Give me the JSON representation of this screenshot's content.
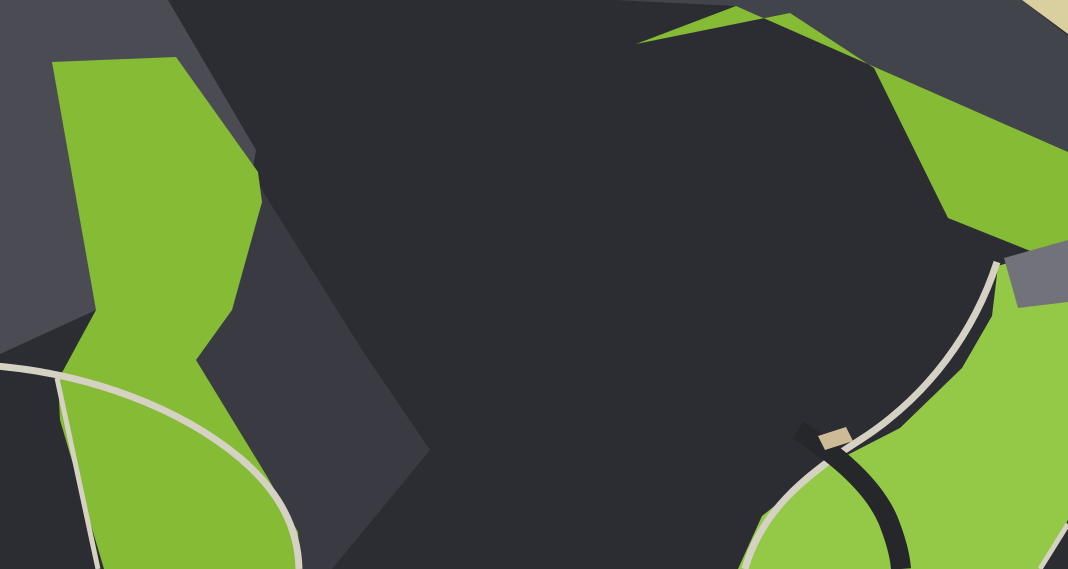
{
  "meta": {
    "title": "Aerial 3D architectural rendering of a two-level parking structure with full rooftop parking deck, ground-level parking bays, access roads with painted arrows, lawns, trees and a stair tower",
    "width": 1068,
    "height": 569
  },
  "palette": {
    "base": "#2c2d32",
    "lotLane": "#3a3b42",
    "tlRoad": "#4b4c53",
    "trRoad": "#42444b",
    "deck": "#7e786e",
    "deckLight": "#867f74",
    "grass": "#85bb35",
    "grassLight": "#94c847",
    "grassDark": "#6da32b",
    "curb": "#d5d1c3",
    "walk": "#aaa79e",
    "grayPath": "#72737a",
    "tanCorner": "#d9cf9f",
    "bldg": "#f3e6b1",
    "bldgSide": "#e6d493",
    "bldgSlot": "#6f6b5d",
    "ramp": "#eedfa0",
    "rampWall": "#dfcc82",
    "white": "#f3f3ef",
    "whiteShade": "#d9d9d4",
    "louver": "#a49f94",
    "louverLine": "#6e695f",
    "colFront": "#ecebe7",
    "colSide": "#c6c5c0",
    "fence": "#232327",
    "steps": "#303034",
    "stepsBand": "#45454b",
    "stairSide": "#c9c6b9",
    "mark": "#f2f1ec",
    "treeDark": "#4e8335",
    "tree": "#69a23f",
    "treeLight": "#82b94e",
    "rock": "#cdbb97",
    "rockEdge": "#b1a07e",
    "bench": "#e2dfd3",
    "glass": "#7c8ca2",
    "glassDark": "#55647a",
    "marker": "#ef9433",
    "post": "#2c3240"
  },
  "car_colors": {
    "silver": {
      "b": "#d5d7dc",
      "h": "#edeff2",
      "s": "#b6b9c0"
    },
    "white": {
      "b": "#e9eaed",
      "h": "#f9fafb",
      "s": "#cfd2d6"
    },
    "gray": {
      "b": "#9b9ea4",
      "h": "#b8bbc0",
      "s": "#83868c"
    },
    "dark": {
      "b": "#44474d",
      "h": "#5d6168",
      "s": "#303338"
    }
  },
  "roof_colors": {
    "tan": "#d7c18d",
    "silver": "#cdd0d5",
    "white": "#e3e5e8",
    "dark": "#52565c"
  },
  "ground": {
    "lot_lane": [
      [
        96,
        310
      ],
      [
        252,
        174
      ],
      [
        362,
        350
      ],
      [
        430,
        450
      ],
      [
        332,
        569
      ],
      [
        300,
        569
      ],
      [
        268,
        478
      ],
      [
        196,
        360
      ]
    ],
    "tl_road": [
      [
        0,
        0
      ],
      [
        168,
        0
      ],
      [
        256,
        150
      ],
      [
        252,
        174
      ],
      [
        96,
        310
      ],
      [
        0,
        354
      ]
    ],
    "tr_road": [
      [
        616,
        0
      ],
      [
        1022,
        0
      ],
      [
        1068,
        36
      ],
      [
        1068,
        152
      ],
      [
        736,
        6
      ]
    ],
    "tr_corner": [
      [
        1022,
        0
      ],
      [
        1068,
        0
      ],
      [
        1068,
        34
      ]
    ],
    "grass_left": [
      [
        52,
        62
      ],
      [
        176,
        57
      ],
      [
        258,
        172
      ],
      [
        262,
        202
      ],
      [
        232,
        310
      ],
      [
        196,
        360
      ],
      [
        268,
        478
      ],
      [
        298,
        532
      ],
      [
        300,
        569
      ],
      [
        104,
        569
      ],
      [
        60,
        420
      ],
      [
        58,
        380
      ],
      [
        96,
        310
      ]
    ],
    "grass_tr": [
      [
        636,
        44
      ],
      [
        736,
        6
      ],
      [
        1068,
        152
      ],
      [
        1068,
        266
      ],
      [
        948,
        218
      ],
      [
        874,
        68
      ],
      [
        790,
        13
      ]
    ],
    "grass_br": [
      [
        998,
        266
      ],
      [
        1068,
        244
      ],
      [
        1068,
        520
      ],
      [
        1040,
        569
      ],
      [
        738,
        569
      ],
      [
        762,
        516
      ],
      [
        822,
        468
      ],
      [
        900,
        428
      ],
      [
        962,
        368
      ],
      [
        992,
        316
      ]
    ],
    "gray_path": [
      [
        1004,
        258
      ],
      [
        1068,
        240
      ],
      [
        1068,
        302
      ],
      [
        1018,
        308
      ]
    ],
    "curb_bl": "M -4,366 C 90,374 180,408 240,458 C 280,492 298,528 299,569",
    "curb_left": "M 57,378 L 98,569",
    "curb_br": "M 997,262 C 975,330 930,395 860,440 C 800,478 760,515 745,569",
    "curb_corner": "M 1040,569 L 1068,524",
    "br_path": "M 798,430 C 845,460 875,490 888,520 C 896,540 900,555 901,569",
    "stone_wall": [
      [
        818,
        436
      ],
      [
        846,
        427
      ],
      [
        853,
        441
      ],
      [
        825,
        450
      ]
    ]
  },
  "building": {
    "body": [
      [
        168,
        0
      ],
      [
        622,
        0
      ],
      [
        622,
        55
      ],
      [
        256,
        150
      ]
    ],
    "left_face": [
      [
        168,
        0
      ],
      [
        200,
        0
      ],
      [
        268,
        140
      ],
      [
        256,
        150
      ]
    ],
    "slot": [
      [
        543,
        0
      ],
      [
        560,
        0
      ],
      [
        560,
        46
      ],
      [
        543,
        52
      ]
    ],
    "seams": [
      [
        350,
        0,
        385,
        92
      ],
      [
        480,
        0,
        505,
        82
      ]
    ],
    "shadow": [
      [
        172,
        112
      ],
      [
        618,
        57
      ],
      [
        628,
        72
      ],
      [
        258,
        182
      ],
      [
        182,
        130
      ]
    ],
    "walkway": [
      254,
      170,
      610,
      74
    ],
    "fence": [
      [
        174,
        110
      ],
      [
        618,
        56
      ]
    ],
    "ramps": [
      {
        "x": 316,
        "y": 102,
        "rot": 250,
        "sc": 0.8
      },
      {
        "x": 450,
        "y": 82,
        "rot": 250,
        "sc": 1.0
      },
      {
        "x": 575,
        "y": 52,
        "rot": 250,
        "sc": 1.0
      }
    ]
  },
  "deck": {
    "surface": [
      [
        218,
        196
      ],
      [
        612,
        60
      ],
      [
        790,
        12
      ],
      [
        875,
        70
      ],
      [
        948,
        216
      ],
      [
        362,
        348
      ]
    ],
    "sun_patch": [
      [
        612,
        60
      ],
      [
        790,
        12
      ],
      [
        875,
        70
      ],
      [
        948,
        216
      ],
      [
        760,
        150
      ]
    ],
    "fence_edge": [
      [
        790,
        12
      ],
      [
        872,
        66
      ],
      [
        948,
        216
      ]
    ],
    "slope_fences": [
      [
        [
          628,
          58
        ],
        [
          736,
          8
        ]
      ],
      [
        [
          736,
          8
        ],
        [
          1068,
          148
        ]
      ]
    ],
    "aisle_dashes": [
      [
        402,
        150,
        470,
        257
      ],
      [
        586,
        96,
        668,
        225
      ],
      [
        742,
        52,
        822,
        178
      ]
    ],
    "fascia_se": [
      [
        948,
        216
      ],
      [
        362,
        348
      ],
      [
        362,
        361
      ],
      [
        948,
        229
      ]
    ],
    "fascia_w": [
      [
        362,
        348
      ],
      [
        218,
        196
      ],
      [
        218,
        209
      ],
      [
        362,
        361
      ]
    ],
    "louver_se": [
      [
        948,
        229
      ],
      [
        362,
        361
      ],
      [
        362,
        386
      ],
      [
        948,
        254
      ]
    ],
    "louver_w": [
      [
        362,
        361
      ],
      [
        218,
        209
      ],
      [
        218,
        239
      ],
      [
        362,
        391
      ]
    ],
    "louver_lines_se": [
      [
        944,
        237,
        366,
        369
      ],
      [
        944,
        244,
        366,
        376
      ],
      [
        944,
        250,
        366,
        382
      ]
    ],
    "louver_lines_w": [
      [
        358,
        368,
        222,
        216
      ],
      [
        358,
        376,
        222,
        224
      ],
      [
        358,
        384,
        222,
        232
      ]
    ],
    "under_shadow": [
      [
        362,
        361
      ],
      [
        948,
        229
      ],
      [
        966,
        300
      ],
      [
        430,
        452
      ]
    ],
    "columns_se": [
      [
        895,
        266,
        84
      ],
      [
        800,
        287,
        74
      ],
      [
        706,
        309,
        64
      ],
      [
        612,
        330,
        54
      ],
      [
        518,
        351,
        46
      ],
      [
        424,
        372,
        40
      ]
    ],
    "columns_w": [
      [
        252,
        275,
        32
      ],
      [
        300,
        326,
        36
      ],
      [
        344,
        372,
        40
      ],
      [
        360,
        389,
        42
      ]
    ]
  },
  "tower": {
    "roof": [
      [
        912,
        92
      ],
      [
        1000,
        86
      ],
      [
        1009,
        114
      ],
      [
        920,
        121
      ]
    ],
    "skylight": [
      [
        938,
        99
      ],
      [
        985,
        95
      ],
      [
        992,
        110
      ],
      [
        945,
        114
      ]
    ],
    "front": [
      [
        920,
        121
      ],
      [
        1009,
        114
      ],
      [
        1009,
        275
      ],
      [
        928,
        264
      ]
    ],
    "side": [
      [
        906,
        129
      ],
      [
        920,
        121
      ],
      [
        928,
        264
      ],
      [
        911,
        252
      ]
    ],
    "window": [
      [
        950,
        184
      ],
      [
        983,
        180
      ],
      [
        985,
        226
      ],
      [
        952,
        230
      ]
    ]
  },
  "rows": [
    {
      "name": "deck-row-a",
      "start": [
        306,
        168
      ],
      "step": [
        14,
        22
      ],
      "count": 8,
      "rot": 237,
      "len": 54,
      "wid": 28,
      "tick": 24,
      "posts": true,
      "roofs": [
        "tan",
        "silver",
        "tan",
        "silver",
        "tan",
        "tan",
        "silver",
        "tan"
      ],
      "bodies": [
        "silver",
        "white",
        "silver",
        "silver",
        "white",
        "silver",
        "silver",
        "white"
      ]
    },
    {
      "name": "deck-row-b1",
      "start": [
        440,
        124
      ],
      "step": [
        15,
        22.5
      ],
      "count": 7,
      "rot": 237,
      "len": 54,
      "wid": 28,
      "tick": 24,
      "posts": true,
      "roofs": [
        "silver",
        "tan",
        "tan",
        "silver",
        "tan",
        "silver",
        "tan"
      ],
      "bodies": [
        "white",
        "silver",
        "silver",
        "white",
        "silver",
        "silver",
        "silver"
      ]
    },
    {
      "name": "deck-row-b2",
      "start": [
        484,
        110
      ],
      "step": [
        15,
        22.5
      ],
      "count": 7,
      "rot": 237,
      "len": 54,
      "wid": 28,
      "tick": 24,
      "posts": true,
      "roofs": [
        "tan",
        "silver",
        "tan",
        "tan",
        "silver",
        "tan",
        "silver"
      ],
      "bodies": [
        "silver",
        "silver",
        "white",
        "silver",
        "silver",
        "white",
        "silver"
      ]
    },
    {
      "name": "deck-row-c1",
      "start": [
        610,
        44
      ],
      "step": [
        15,
        22.5
      ],
      "count": 9,
      "rot": 237,
      "len": 54,
      "wid": 28,
      "tick": 24,
      "posts": true,
      "roofs": [
        "silver",
        "tan",
        "silver",
        "tan",
        "tan",
        "silver",
        "tan",
        "silver",
        "tan"
      ],
      "bodies": [
        "silver",
        "white",
        "silver",
        "silver",
        "white",
        "silver",
        "silver",
        "silver",
        "white"
      ]
    },
    {
      "name": "deck-row-c2",
      "start": [
        654,
        30
      ],
      "step": [
        15,
        22.5
      ],
      "count": 9,
      "rot": 237,
      "len": 54,
      "wid": 28,
      "tick": 24,
      "posts": true,
      "roofs": [
        "tan",
        "tan",
        "silver",
        "tan",
        "silver",
        "tan",
        "silver",
        "tan",
        "silver"
      ],
      "bodies": [
        "white",
        "silver",
        "silver",
        "white",
        "silver",
        "silver",
        "white",
        "silver",
        "silver"
      ]
    },
    {
      "name": "deck-row-d1",
      "start": [
        780,
        30
      ],
      "step": [
        15,
        22.5
      ],
      "count": 8,
      "rot": 237,
      "len": 54,
      "wid": 28,
      "tick": 24,
      "posts": true,
      "roofs": [
        "silver",
        "tan",
        "tan",
        "silver",
        "tan",
        "silver",
        "tan",
        "tan"
      ],
      "bodies": [
        "silver",
        "white",
        "silver",
        "silver",
        "silver",
        "white",
        "silver",
        "silver"
      ]
    },
    {
      "name": "deck-row-d2",
      "start": [
        820,
        42
      ],
      "step": [
        15,
        22.5
      ],
      "count": 7,
      "rot": 237,
      "len": 54,
      "wid": 28,
      "tick": 24,
      "posts": true,
      "roofs": [
        "tan",
        "silver",
        "tan",
        "silver",
        "tan",
        "tan",
        "silver"
      ],
      "bodies": [
        "white",
        "silver",
        "silver",
        "white",
        "silver",
        "silver",
        "silver"
      ]
    },
    {
      "name": "ground-row",
      "start": [
        565,
        342
      ],
      "step": [
        40,
        -14
      ],
      "count": 9,
      "rot": 193,
      "len": 58,
      "wid": 30,
      "tick": 32,
      "posts": false,
      "roofs": [
        "silver",
        "white",
        "silver",
        "silver",
        "white",
        "silver",
        "white",
        "silver",
        "silver"
      ],
      "bodies": [
        "silver",
        "white",
        "silver",
        "white",
        "silver",
        "silver",
        "white",
        "silver",
        "silver"
      ]
    },
    {
      "name": "van-stalls",
      "start": [
        392,
        404
      ],
      "step": [
        57,
        -18
      ],
      "count": 2,
      "rot": 197,
      "len": 64,
      "wid": 34,
      "tick": 34,
      "posts": false,
      "van": true,
      "roofs": [
        "white",
        "silver"
      ],
      "bodies": [
        "white",
        "silver"
      ]
    }
  ],
  "single_cars": [
    {
      "name": "deck-parked-dark-car",
      "x": 252,
      "y": 182,
      "rot": 237,
      "body": "dark",
      "roof": "dark",
      "len": 54,
      "wid": 28
    },
    {
      "name": "deck-driving-car",
      "x": 716,
      "y": 56,
      "rot": 237,
      "body": "gray",
      "roof": "silver",
      "len": 54,
      "wid": 28
    },
    {
      "name": "tower-base-car-1",
      "x": 930,
      "y": 190,
      "rot": 240,
      "body": "silver",
      "roof": "tan",
      "len": 56,
      "wid": 29
    },
    {
      "name": "tower-base-car-2",
      "x": 965,
      "y": 203,
      "rot": 240,
      "body": "silver",
      "roof": "silver",
      "len": 56,
      "wid": 29
    },
    {
      "name": "road-car-bl",
      "x": 312,
      "y": 514,
      "rot": 18,
      "body": "silver",
      "roof": "silver",
      "len": 58,
      "wid": 30
    },
    {
      "name": "road-car-bottom-white",
      "x": 547,
      "y": 558,
      "rot": 212,
      "body": "white",
      "roof": "white",
      "len": 58,
      "wid": 30
    },
    {
      "name": "road-car-dark",
      "x": 708,
      "y": 502,
      "rot": 206,
      "body": "dark",
      "roof": "dark",
      "len": 58,
      "wid": 30
    },
    {
      "name": "road-car-gray",
      "x": 614,
      "y": 556,
      "rot": 206,
      "body": "gray",
      "roof": "silver",
      "len": 58,
      "wid": 30
    },
    {
      "name": "road-car-silver",
      "x": 890,
      "y": 400,
      "rot": 207,
      "body": "silver",
      "roof": "white",
      "len": 58,
      "wid": 30
    },
    {
      "name": "road-car-right-edge",
      "x": 1054,
      "y": 316,
      "rot": 204,
      "body": "white",
      "roof": "white",
      "len": 58,
      "wid": 30
    }
  ],
  "arrows": [
    {
      "type": "straight",
      "x": 562,
      "y": 122,
      "rot": 237,
      "zone": "deck"
    },
    {
      "type": "straight",
      "x": 596,
      "y": 150,
      "rot": 237,
      "zone": "deck"
    },
    {
      "type": "straight",
      "x": 648,
      "y": 100,
      "rot": 57,
      "zone": "deck"
    },
    {
      "type": "straight",
      "x": 758,
      "y": 130,
      "rot": 57,
      "zone": "deck"
    },
    {
      "type": "left",
      "x": 252,
      "y": 233,
      "rot": -30,
      "zone": "deck"
    },
    {
      "type": "straight",
      "x": 281,
      "y": 270,
      "rot": 237,
      "zone": "deck"
    },
    {
      "type": "left",
      "x": 912,
      "y": 269,
      "rot": 12,
      "zone": "road"
    },
    {
      "type": "right",
      "x": 951,
      "y": 291,
      "rot": 8,
      "zone": "road"
    },
    {
      "type": "left",
      "x": 728,
      "y": 363,
      "rot": 12,
      "zone": "road"
    },
    {
      "type": "straight-right",
      "x": 747,
      "y": 402,
      "rot": -18,
      "zone": "road"
    },
    {
      "type": "straight-right",
      "x": 470,
      "y": 513,
      "rot": -8,
      "zone": "road"
    }
  ],
  "stairs": {
    "from": [
      250,
      170
    ],
    "to": [
      106,
      300
    ],
    "steps": 11
  },
  "trees_small": [
    [
      122,
      82
    ],
    [
      136,
      110
    ],
    [
      150,
      138
    ],
    [
      163,
      166
    ],
    [
      168,
      232
    ],
    [
      182,
      264
    ],
    [
      196,
      297
    ],
    [
      207,
      331
    ]
  ],
  "trees_big": [
    [
      858,
      468,
      32
    ],
    [
      948,
      424,
      26
    ],
    [
      1036,
      332,
      27
    ],
    [
      1042,
      472,
      30
    ],
    [
      772,
      557,
      26
    ],
    [
      988,
      548,
      20
    ]
  ],
  "rocks": [
    [
      904,
      440,
      9
    ],
    [
      925,
      424,
      8
    ],
    [
      944,
      408,
      8
    ]
  ],
  "benches": [
    [
      952,
      534,
      100,
      33
    ],
    [
      1036,
      562,
      80,
      33
    ]
  ],
  "bins": [
    [
      42,
      283
    ],
    [
      40,
      557
    ]
  ],
  "people": [
    {
      "name": "person-walking-on-deck",
      "x": 262,
      "y": 146,
      "pose": "standing",
      "color": "#46433f"
    },
    {
      "name": "person-sitting-on-grass",
      "x": 933,
      "y": 478,
      "pose": "sitting",
      "color": "#c96f2f"
    }
  ],
  "stall_labels": [
    {
      "text": "1",
      "x": 463,
      "y": 429,
      "rot": -15
    },
    {
      "text": "2",
      "x": 417,
      "y": 448,
      "rot": -15
    }
  ]
}
